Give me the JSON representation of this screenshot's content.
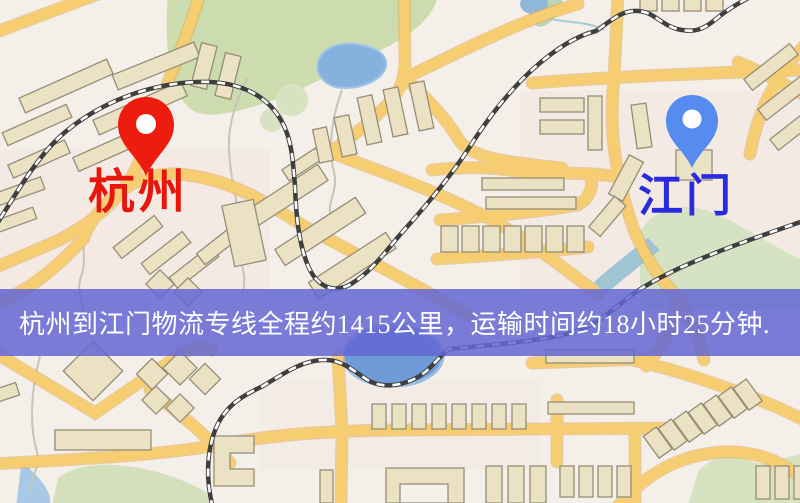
{
  "map": {
    "description": "杭州到江门物流专线地图",
    "origin_marker": {
      "label": "杭州",
      "label_color": "#e8170c",
      "pin_color": "#ee1c0f",
      "pin_shape": "map-pin"
    },
    "destination_marker": {
      "label": "江门",
      "label_color": "#2b2bdd",
      "pin_color": "#568cf0",
      "pin_shape": "map-pin"
    },
    "colors": {
      "background": "#f4efe9",
      "road": "#f6cd70",
      "road_casing": "#e3ad56",
      "park": "#ccdcae",
      "water": "#85b2dd",
      "building": "#ebe2c4",
      "railway": "#3f3f3f"
    }
  },
  "banner": {
    "text": "杭州到江门物流专线全程约1415公里，运输时间约18小时25分钟.",
    "from": "杭州",
    "to": "江门",
    "distance_km": "1415",
    "duration": "18小时25分钟",
    "background_color": "#6366d4",
    "text_color": "#ffffff"
  }
}
